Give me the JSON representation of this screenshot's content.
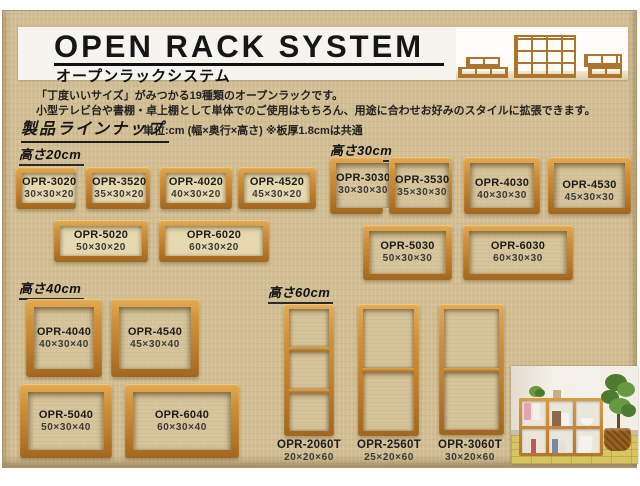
{
  "header": {
    "title": "OPEN RACK SYSTEM",
    "subtitle": "オープンラックシステム"
  },
  "intro": {
    "line1": "「丁度いいサイズ」がみつかる19種類のオープンラックです。",
    "line2": "小型テレビ台や書棚・卓上棚として単体でのご使用はもちろん、用途に合わせお好みのスタイルに拡張できます。"
  },
  "lineup": {
    "heading": "製品ラインナップ",
    "unit_note": "単位:cm (幅×奥行×高さ) ※板厚1.8cmは共通"
  },
  "sections": [
    {
      "label": "高さ20cm",
      "products": [
        {
          "model": "OPR-3020",
          "size": "30×30×20"
        },
        {
          "model": "OPR-3520",
          "size": "35×30×20"
        },
        {
          "model": "OPR-4020",
          "size": "40×30×20"
        },
        {
          "model": "OPR-4520",
          "size": "45×30×20"
        },
        {
          "model": "OPR-5020",
          "size": "50×30×20"
        },
        {
          "model": "OPR-6020",
          "size": "60×30×20"
        }
      ]
    },
    {
      "label": "高さ30cm",
      "products": [
        {
          "model": "OPR-3030",
          "size": "30×30×30"
        },
        {
          "model": "OPR-3530",
          "size": "35×30×30"
        },
        {
          "model": "OPR-4030",
          "size": "40×30×30"
        },
        {
          "model": "OPR-4530",
          "size": "45×30×30"
        },
        {
          "model": "OPR-5030",
          "size": "50×30×30"
        },
        {
          "model": "OPR-6030",
          "size": "60×30×30"
        }
      ]
    },
    {
      "label": "高さ40cm",
      "products": [
        {
          "model": "OPR-4040",
          "size": "40×30×40"
        },
        {
          "model": "OPR-4540",
          "size": "45×30×40"
        },
        {
          "model": "OPR-5040",
          "size": "50×30×40"
        },
        {
          "model": "OPR-6040",
          "size": "60×30×40"
        }
      ]
    },
    {
      "label": "高さ60cm",
      "products": [
        {
          "model": "OPR-2060T",
          "size": "20×20×60",
          "compartments": 3
        },
        {
          "model": "OPR-2560T",
          "size": "25×20×60",
          "compartments": 2
        },
        {
          "model": "OPR-3060T",
          "size": "30×20×60",
          "compartments": 2
        }
      ]
    }
  ],
  "colors": {
    "wood": "#c98732",
    "background": "#d2bf95",
    "title_text": "#161616"
  }
}
